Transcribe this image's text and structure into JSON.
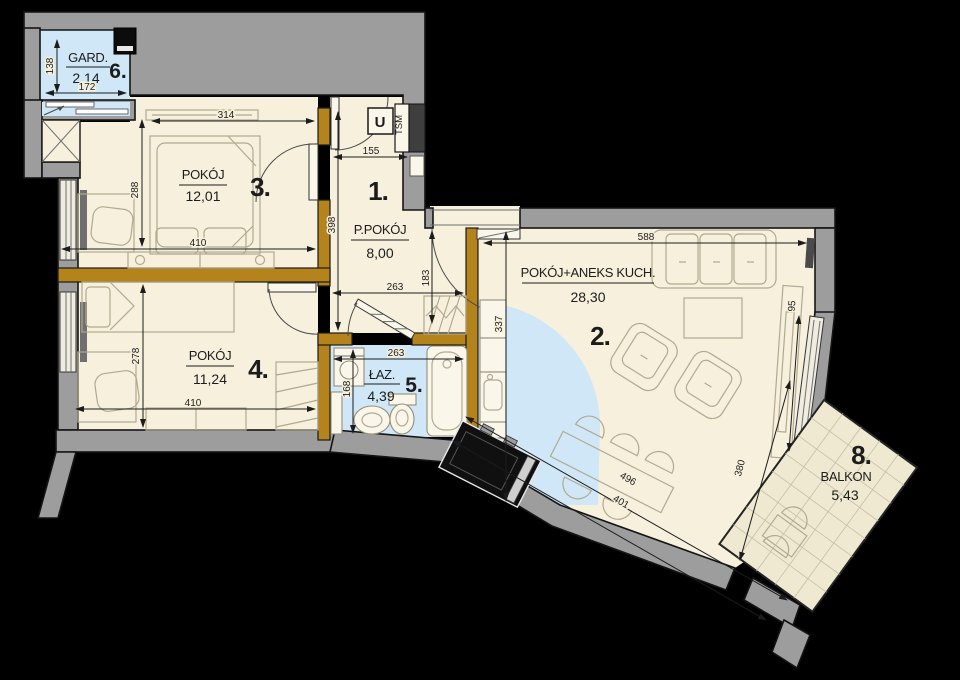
{
  "title": "apartment-floor-plan",
  "rooms": {
    "r1": {
      "num": "1.",
      "name": "P.POKÓJ",
      "area": "8,00"
    },
    "r2": {
      "num": "2.",
      "name": "POKÓJ+ANEKS  KUCH.",
      "area": "28,30"
    },
    "r3": {
      "num": "3.",
      "name": "POKÓJ",
      "area": "12,01"
    },
    "r4": {
      "num": "4.",
      "name": "POKÓJ",
      "area": "11,24"
    },
    "r5": {
      "num": "5.",
      "name": "ŁAZ.",
      "area": "4,39"
    },
    "r6": {
      "num": "6.",
      "name": "GARD.",
      "area": "2,14"
    },
    "r8": {
      "num": "8.",
      "name": "BALKON",
      "area": "5,43"
    }
  },
  "annotations": {
    "utility_u": "U",
    "utility_tsm": "TSM"
  },
  "dimensions": {
    "gard_height": "138",
    "gard_width": "172",
    "r3_top": "314",
    "r3_left": "288",
    "r3_bottom": "410",
    "r1_left": "398",
    "r1_top": "155",
    "r1_entry": "183",
    "hall_width": "263",
    "bath_width": "263",
    "bath_height": "168",
    "r4_left": "278",
    "r4_bottom": "410",
    "r2_top": "588",
    "r2_right": "95",
    "kitchen_height": "337",
    "r2_diag_outer": "496",
    "r2_diag_inner": "401",
    "balcony_door": "380"
  },
  "colors": {
    "background": "#000000",
    "wall": "#9d9d9d",
    "partition": "#b5831c",
    "floor": "#f6f0dd",
    "wet_zone": "#cfe7f7",
    "balcony": "#efe9d2"
  }
}
